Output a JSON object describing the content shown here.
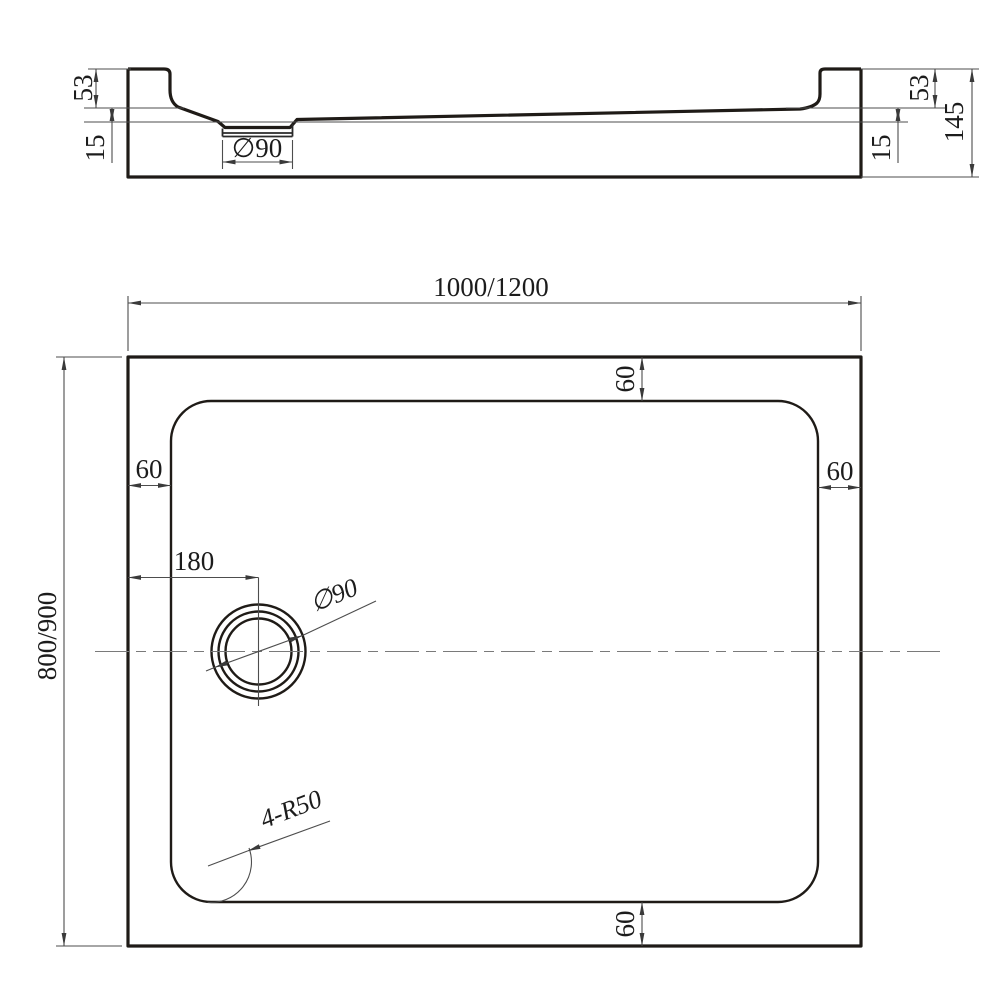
{
  "drawing_title": "shower-tray-technical-drawing",
  "colors": {
    "background": "#ffffff",
    "outline": "#1f1b17",
    "dimension_line": "#4d4d4d",
    "text": "#1c1c1c"
  },
  "section_view": {
    "dims": {
      "left_rim_height": "53",
      "left_base_thickness": "15",
      "drain_diameter": "∅90",
      "right_rim_height": "53",
      "right_base_thickness": "15",
      "overall_height": "145"
    }
  },
  "plan_view": {
    "dims": {
      "overall_width": "1000/1200",
      "overall_depth": "800/900",
      "inset_top": "60",
      "inset_left": "60",
      "inset_right": "60",
      "inset_bottom": "60",
      "drain_center_offset": "180",
      "drain_diameter": "∅90",
      "corner_radius": "4-R50"
    }
  }
}
